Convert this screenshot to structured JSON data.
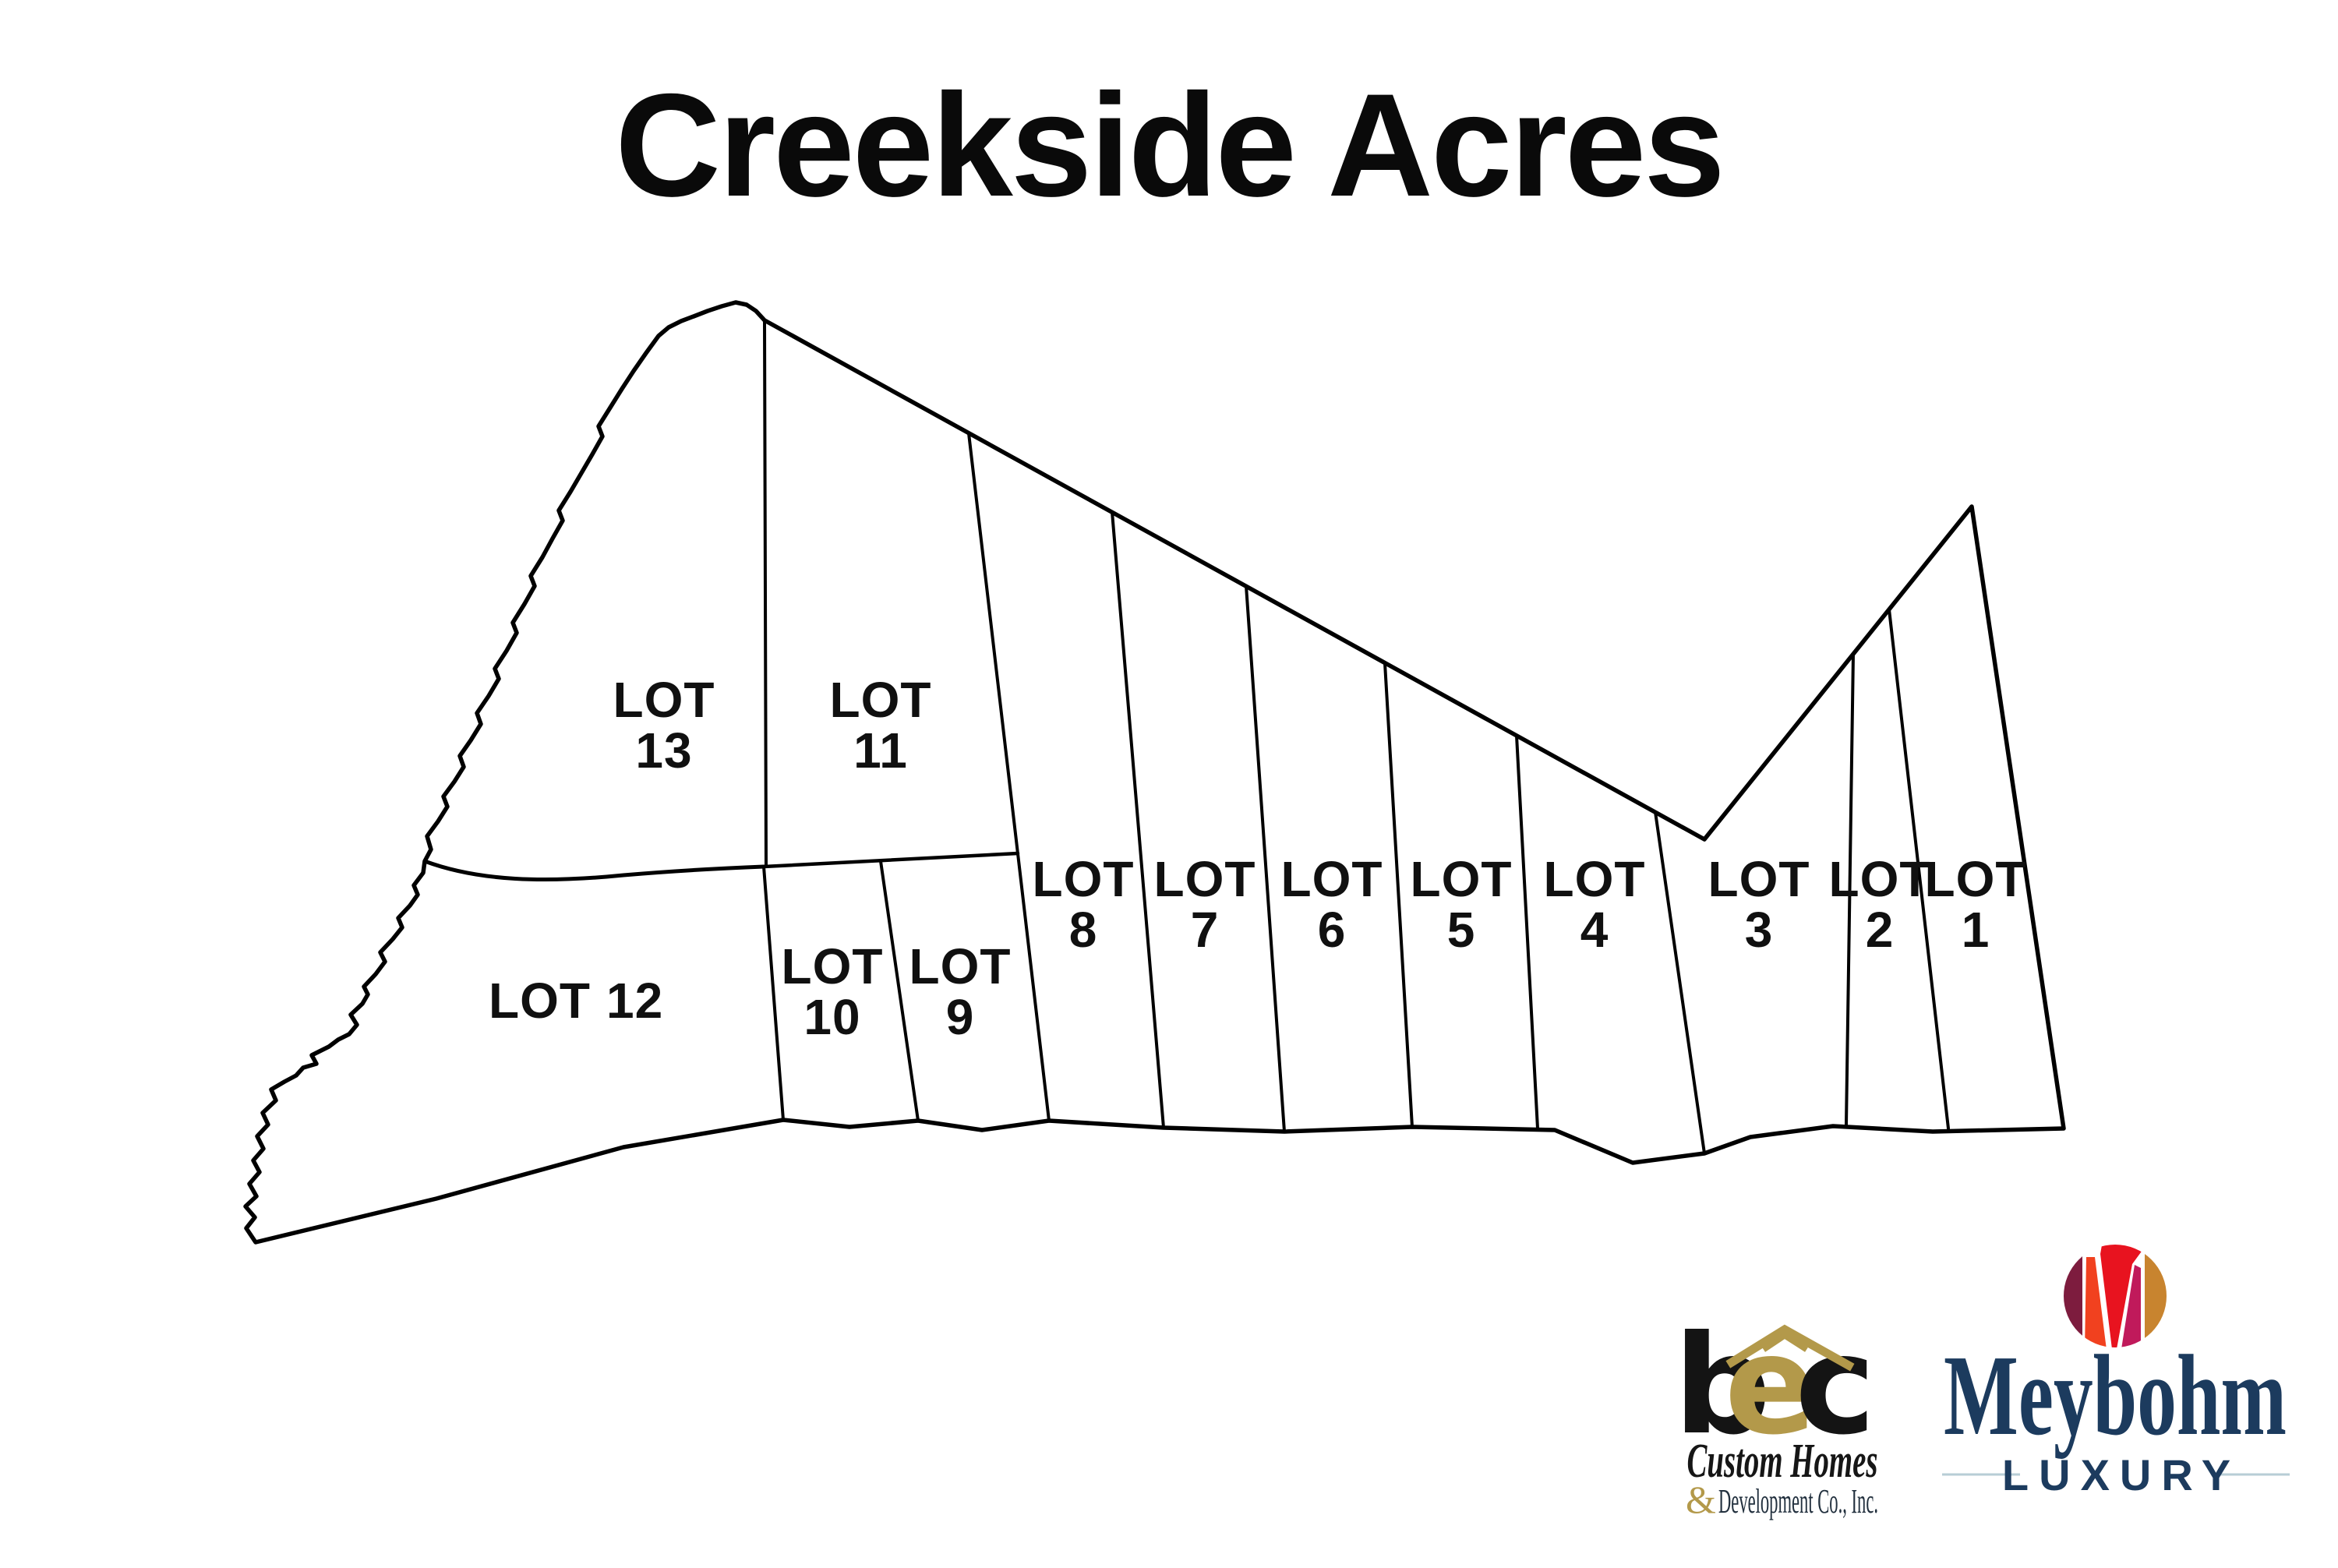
{
  "title": "Creekside Acres",
  "map": {
    "lots": [
      {
        "word": "LOT",
        "num": "1"
      },
      {
        "word": "LOT",
        "num": "2"
      },
      {
        "word": "LOT",
        "num": "3"
      },
      {
        "word": "LOT",
        "num": "4"
      },
      {
        "word": "LOT",
        "num": "5"
      },
      {
        "word": "LOT",
        "num": "6"
      },
      {
        "word": "LOT",
        "num": "7"
      },
      {
        "word": "LOT",
        "num": "8"
      },
      {
        "word": "LOT",
        "num": "9"
      },
      {
        "word": "LOT",
        "num": "10"
      },
      {
        "word": "LOT",
        "num": "11"
      },
      {
        "word": "LOT",
        "num": "12"
      },
      {
        "word": "LOT",
        "num": "13"
      }
    ]
  },
  "footer": {
    "bec": {
      "letter_b": "b",
      "letter_e": "e",
      "letter_c": "c",
      "line1": "Custom Homes",
      "amp": "&",
      "line2": "Development Co., Inc."
    },
    "meybohm": {
      "name": "Meybohm",
      "sub": "LUXURY"
    }
  },
  "colors": {
    "ink": "#000000",
    "label": "#101010",
    "gold": "#b3994a",
    "script": "#161616",
    "dev_text": "#22303e",
    "navy": "#1c3b5e",
    "rule": "#b7cdd6",
    "m_maroon": "#7d1c3e",
    "m_orange": "#f1411f",
    "m_red": "#e8131f",
    "m_magenta": "#c01a5b",
    "m_gold": "#c8842f"
  }
}
